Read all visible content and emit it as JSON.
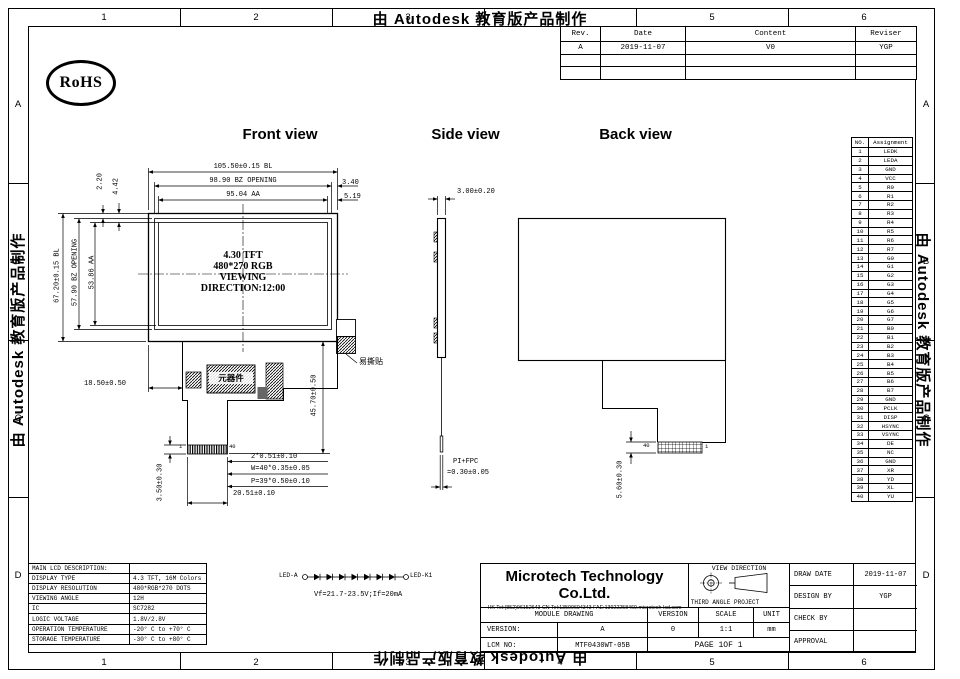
{
  "watermark": "由 Autodesk 教育版产品制作",
  "border": {
    "columns": [
      "1",
      "2",
      "3",
      "4",
      "5",
      "6"
    ],
    "rows": [
      "A",
      "B",
      "C",
      "D"
    ]
  },
  "rohs_label": "RoHS",
  "revision_table": {
    "headers": [
      "Rev.",
      "Date",
      "Content",
      "Reviser"
    ],
    "rows": [
      [
        "A",
        "2019-11-07",
        "V0",
        "YGP"
      ],
      [
        "",
        "",
        "",
        ""
      ],
      [
        "",
        "",
        "",
        ""
      ]
    ]
  },
  "view_titles": {
    "front": "Front view",
    "side": "Side view",
    "back": "Back view"
  },
  "front_view": {
    "dim_bl_width": "105.50±0.15 BL",
    "dim_bz_width": "98.90 BZ OPENING",
    "dim_aa_width": "95.04 AA",
    "dim_right_1": "3.40",
    "dim_right_2": "5.19",
    "dim_top_1": "2.20",
    "dim_top_2": "4.42",
    "dim_bl_height": "67.20±0.15 BL",
    "dim_bz_height": "57.90 BZ OPENING",
    "dim_aa_height": "53.86 AA",
    "panel_text": [
      "4.30  TFT",
      "480*270 RGB",
      "VIEWING",
      "DIRECTION:12:00"
    ],
    "dim_pcb_left": "18.50±0.50",
    "dim_pcb_height": "45.70±0.50",
    "component_label": "元器件",
    "sticker_label": "易撕贴",
    "pin_first": "1",
    "pin_last": "40",
    "dim_fpc_1": "2*0.51±0.10",
    "dim_fpc_2": "W=40*0.35±0.05",
    "dim_fpc_3": "P=39*0.50±0.10",
    "dim_fpc_width": "20.51±0.10",
    "dim_fpc_bottom": "3.50±0.30"
  },
  "side_view": {
    "dim_thickness": "3.00±0.20",
    "dim_fpc_label": "PI+FPC",
    "dim_fpc_value": "=0.30±0.05"
  },
  "back_view": {
    "pin_left": "40",
    "pin_right": "1",
    "dim_connector": "5.60±0.30"
  },
  "led_circuit": {
    "anode_label": "LED-A",
    "cathode_label": "LED-K1",
    "spec": "Vf=21.7-23.5V;If=20mA"
  },
  "lcd_table": {
    "title": "MAIN LCD DESCRIPTION:",
    "rows": [
      [
        "DISPLAY TYPE",
        "4.3 TFT, 16M Colors"
      ],
      [
        "DISPLAY RESOLUTION",
        "480*RGB*270 DOTS"
      ],
      [
        "VIEWING ANGLE",
        "12H"
      ],
      [
        "IC",
        "SC7282"
      ],
      [
        "LOGIC VOLTAGE",
        "1.8V/2.8V"
      ],
      [
        "OPERATION TEMPERATURE",
        "-20° C to +70° C"
      ],
      [
        "STORAGE TEMPERATURE",
        "-30° C to +80° C"
      ]
    ]
  },
  "pin_table": {
    "headers": [
      "NO.",
      "Assignment"
    ],
    "pins": [
      "LEDK",
      "LEDA",
      "GND",
      "VCC",
      "R0",
      "R1",
      "R2",
      "R3",
      "R4",
      "R5",
      "R6",
      "R7",
      "G0",
      "G1",
      "G2",
      "G3",
      "G4",
      "G5",
      "G6",
      "G7",
      "B0",
      "B1",
      "B2",
      "B3",
      "B4",
      "B5",
      "B6",
      "B7",
      "GND",
      "PCLK",
      "DISP",
      "HSYNC",
      "VSYNC",
      "DE",
      "NC",
      "GND",
      "XR",
      "YD",
      "XL",
      "YU"
    ]
  },
  "title_block": {
    "company": "Microtech Technology Co.Ltd.",
    "contact": "HK Tel:(852)96152643 CN Tel:13509694343 FAE:13922258469.microtech-lcd.com",
    "view_direction": "VIEW DIRECTION",
    "projection": "THIRD ANGLE PROJECT",
    "module_drawing": "MODULE DRAWING",
    "col_version": "VERSION",
    "col_scale": "SCALE",
    "col_unit": "UNIT",
    "version_label": "VERSION:",
    "version_value": "A",
    "version_num": "0",
    "scale_value": "1:1",
    "unit_value": "mm",
    "lcm_label": "LCM NO:",
    "lcm_value": "MTF0430WT-05B",
    "page": "PAGE 1OF 1",
    "draw_date_label": "DRAW DATE",
    "draw_date": "2019-11-07",
    "design_by_label": "DESIGN BY",
    "design_by": "YGP",
    "check_by_label": "CHECK BY",
    "check_by": "",
    "approval_label": "APPROVAL",
    "approval": ""
  }
}
